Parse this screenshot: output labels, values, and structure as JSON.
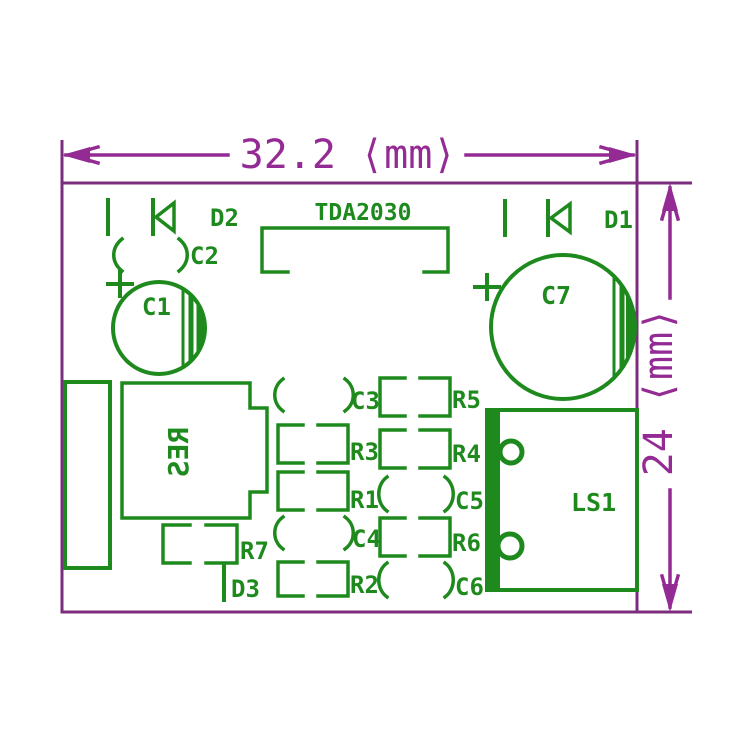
{
  "diagram_title": "TDA2030 amplifier PCB silkscreen drawing",
  "dimension_labels": {
    "width": "32.2 ⟨mm⟩",
    "height": "24 ⟨mm⟩"
  },
  "component_labels": {
    "d2": "D2",
    "tda": "TDA2030",
    "d1": "D1",
    "c2": "C2",
    "c1": "C1",
    "c7": "C7",
    "res": "RES",
    "c3": "C3",
    "r5": "R5",
    "r3": "R3",
    "r4": "R4",
    "r1": "R1",
    "c5": "C5",
    "c4": "C4",
    "r7": "R7",
    "r6": "R6",
    "d3": "D3",
    "r2": "R2",
    "c6": "C6",
    "ls1": "LS1"
  },
  "colors": {
    "silkscreen": "#1e8a1e",
    "dimension": "#942b94",
    "board_outline": "#7c2c7c",
    "background": "#ffffff"
  }
}
